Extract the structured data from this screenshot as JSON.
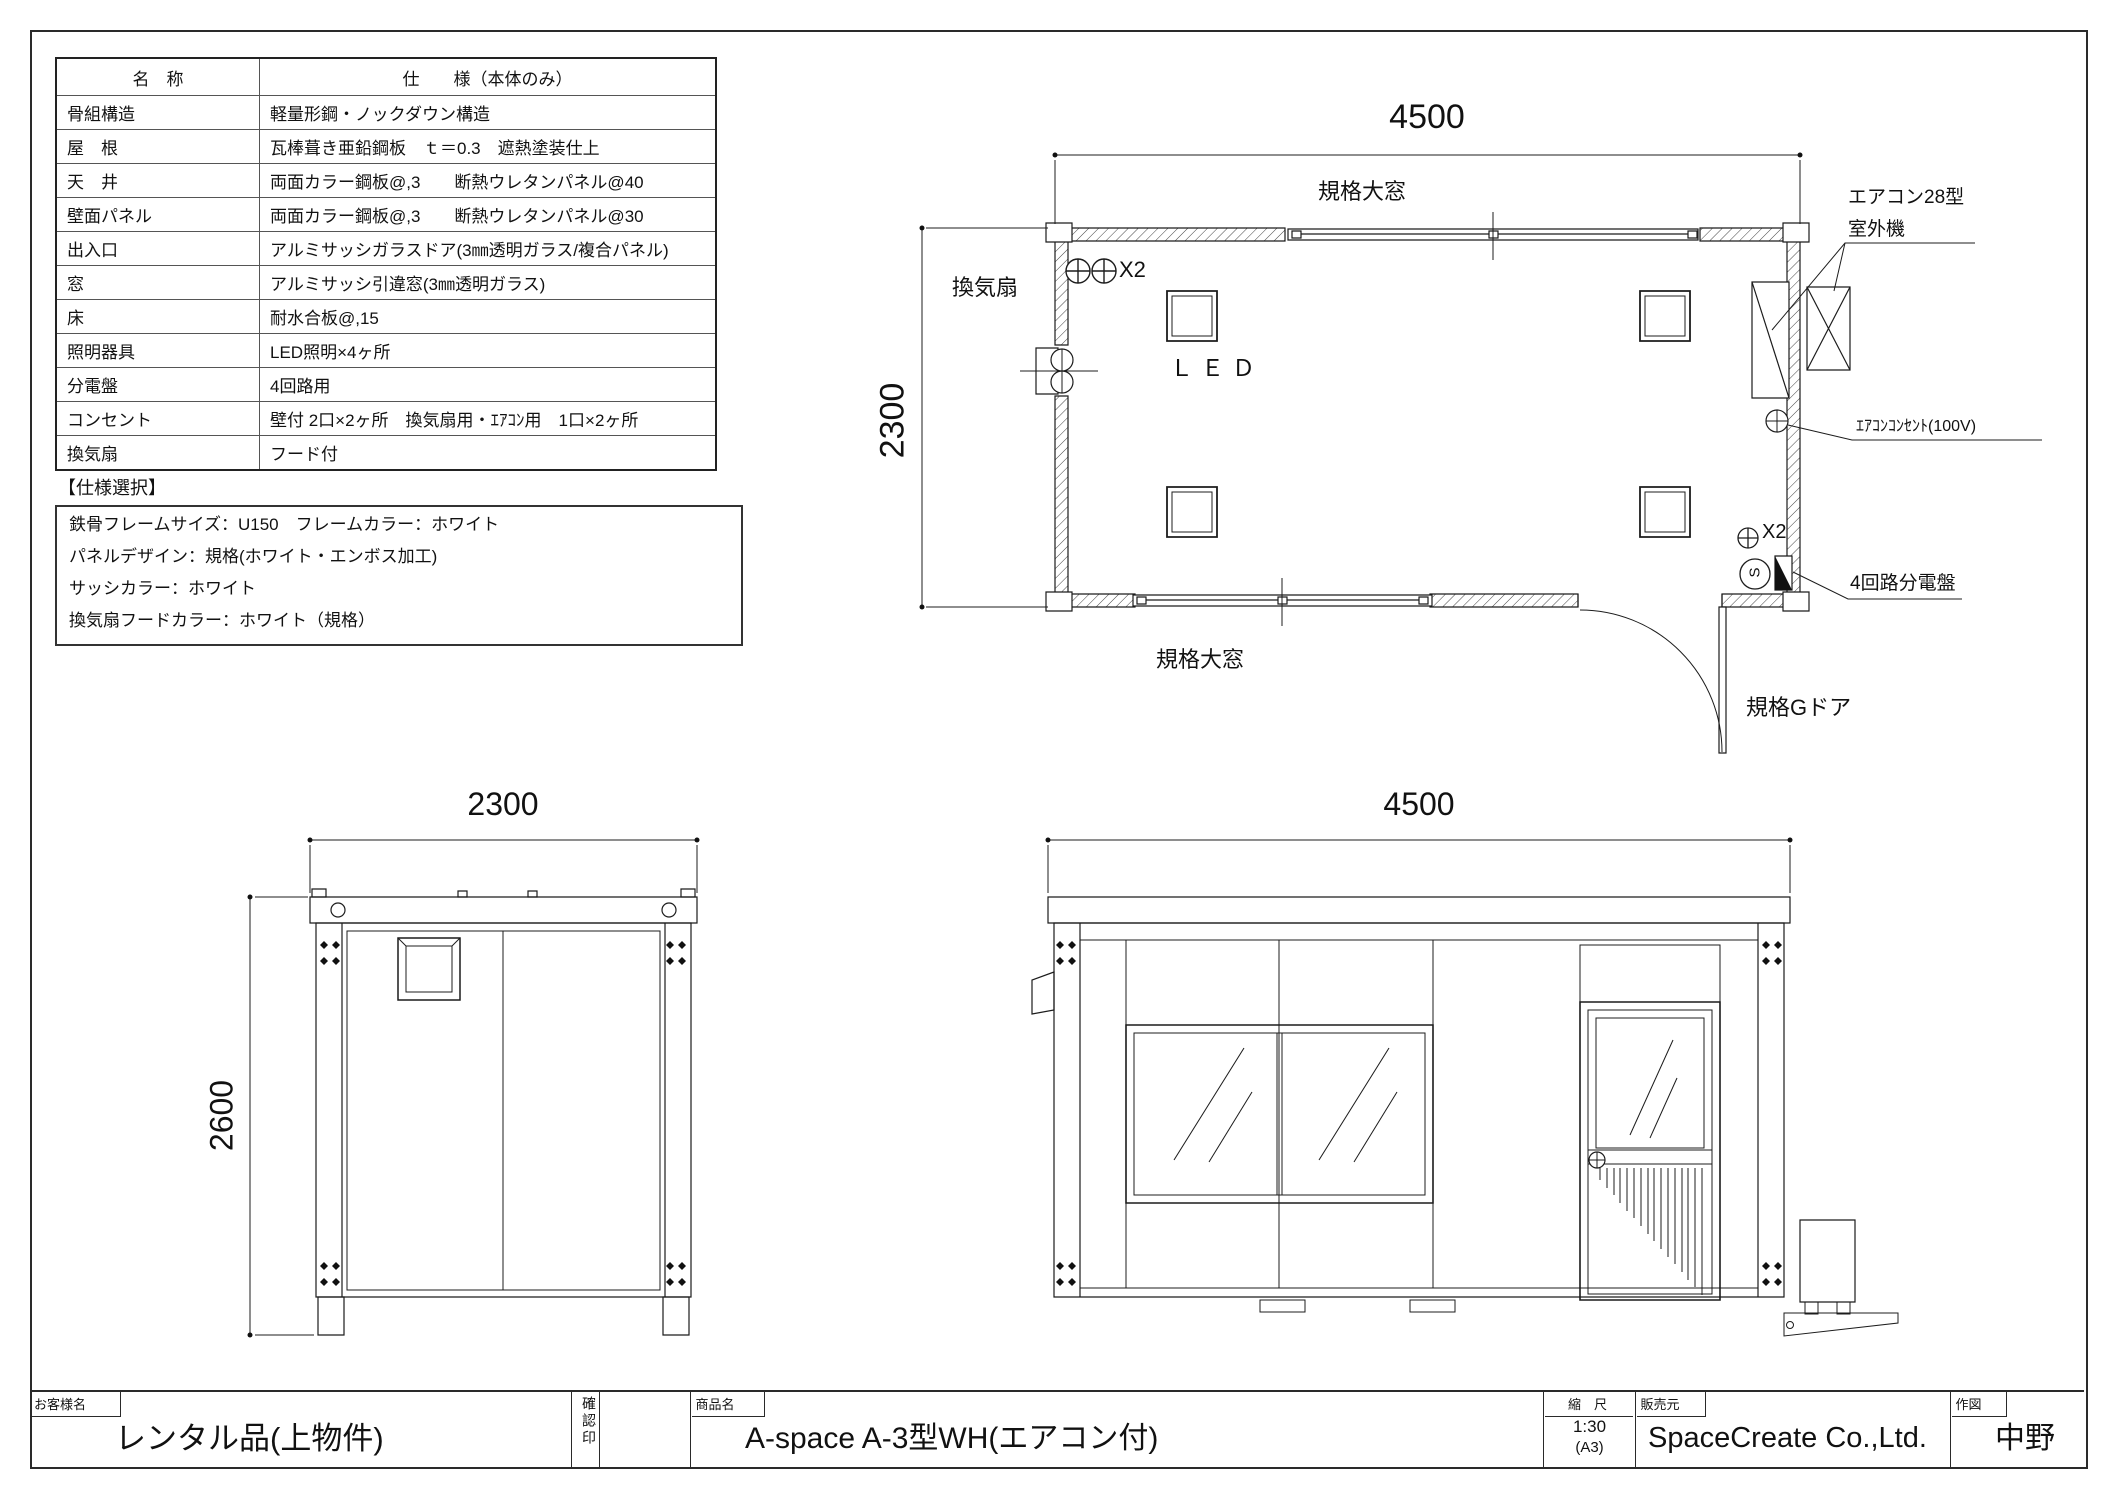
{
  "spec_table": {
    "header": {
      "name": "名　称",
      "spec": "仕　　様（本体のみ）"
    },
    "rows": [
      {
        "name": "骨組構造",
        "spec": "軽量形鋼・ノックダウン構造"
      },
      {
        "name": "屋　根",
        "spec": "瓦棒葺き亜鉛鋼板　ｔ＝0.3　遮熱塗装仕上"
      },
      {
        "name": "天　井",
        "spec": "両面カラー鋼板@,3　　断熱ウレタンパネル@40"
      },
      {
        "name": "壁面パネル",
        "spec": "両面カラー鋼板@,3　　断熱ウレタンパネル@30"
      },
      {
        "name": "出入口",
        "spec": "アルミサッシガラスドア(3㎜透明ガラス/複合パネル)"
      },
      {
        "name": "窓",
        "spec": "アルミサッシ引違窓(3㎜透明ガラス)"
      },
      {
        "name": "床",
        "spec": "耐水合板@,15"
      },
      {
        "name": "照明器具",
        "spec": "LED照明×4ヶ所"
      },
      {
        "name": "分電盤",
        "spec": "4回路用"
      },
      {
        "name": "コンセント",
        "spec": "壁付 2口×2ヶ所　換気扇用・ｴｱｺﾝ用　1口×2ヶ所"
      },
      {
        "name": "換気扇",
        "spec": "フード付"
      }
    ]
  },
  "spec_select": {
    "title": "【仕様選択】",
    "lines": [
      "鉄骨フレームサイズ：U150　フレームカラー：ホワイト",
      "パネルデザイン：規格(ホワイト・エンボス加工)",
      "サッシカラー：ホワイト",
      "換気扇フードカラー：ホワイト（規格）"
    ]
  },
  "floor_plan": {
    "dim_width": "4500",
    "dim_height": "2300",
    "top_window_label": "規格大窓",
    "bottom_window_label": "規格大窓",
    "vent_fan_label": "換気扇",
    "led_label": "ＬＥＤ",
    "x2_top_label": "X2",
    "x2_bottom_label": "X2",
    "switch_label": "S",
    "aircon_label_line1": "エアコン28型",
    "aircon_label_line2": "室外機",
    "aircon_outlet_label": "ｴｱｺﾝｺﾝｾﾝﾄ(100V)",
    "breaker_label": "4回路分電盤",
    "door_label": "規格Gドア"
  },
  "end_elevation": {
    "dim_width": "2300",
    "dim_height": "2600"
  },
  "side_elevation": {
    "dim_width": "4500"
  },
  "title_block": {
    "customer_label": "お客様名",
    "customer": "レンタル品(上物件)",
    "stamp_label": "確認印",
    "product_label": "商品名",
    "product": "A-space A-3型WH(エアコン付)",
    "scale_label": "縮　尺",
    "scale": "1:30",
    "scale_paper": "(A3)",
    "seller_label": "販売元",
    "seller": "SpaceCreate Co.,Ltd.",
    "drafter_label": "作図",
    "drafter": "中野"
  }
}
